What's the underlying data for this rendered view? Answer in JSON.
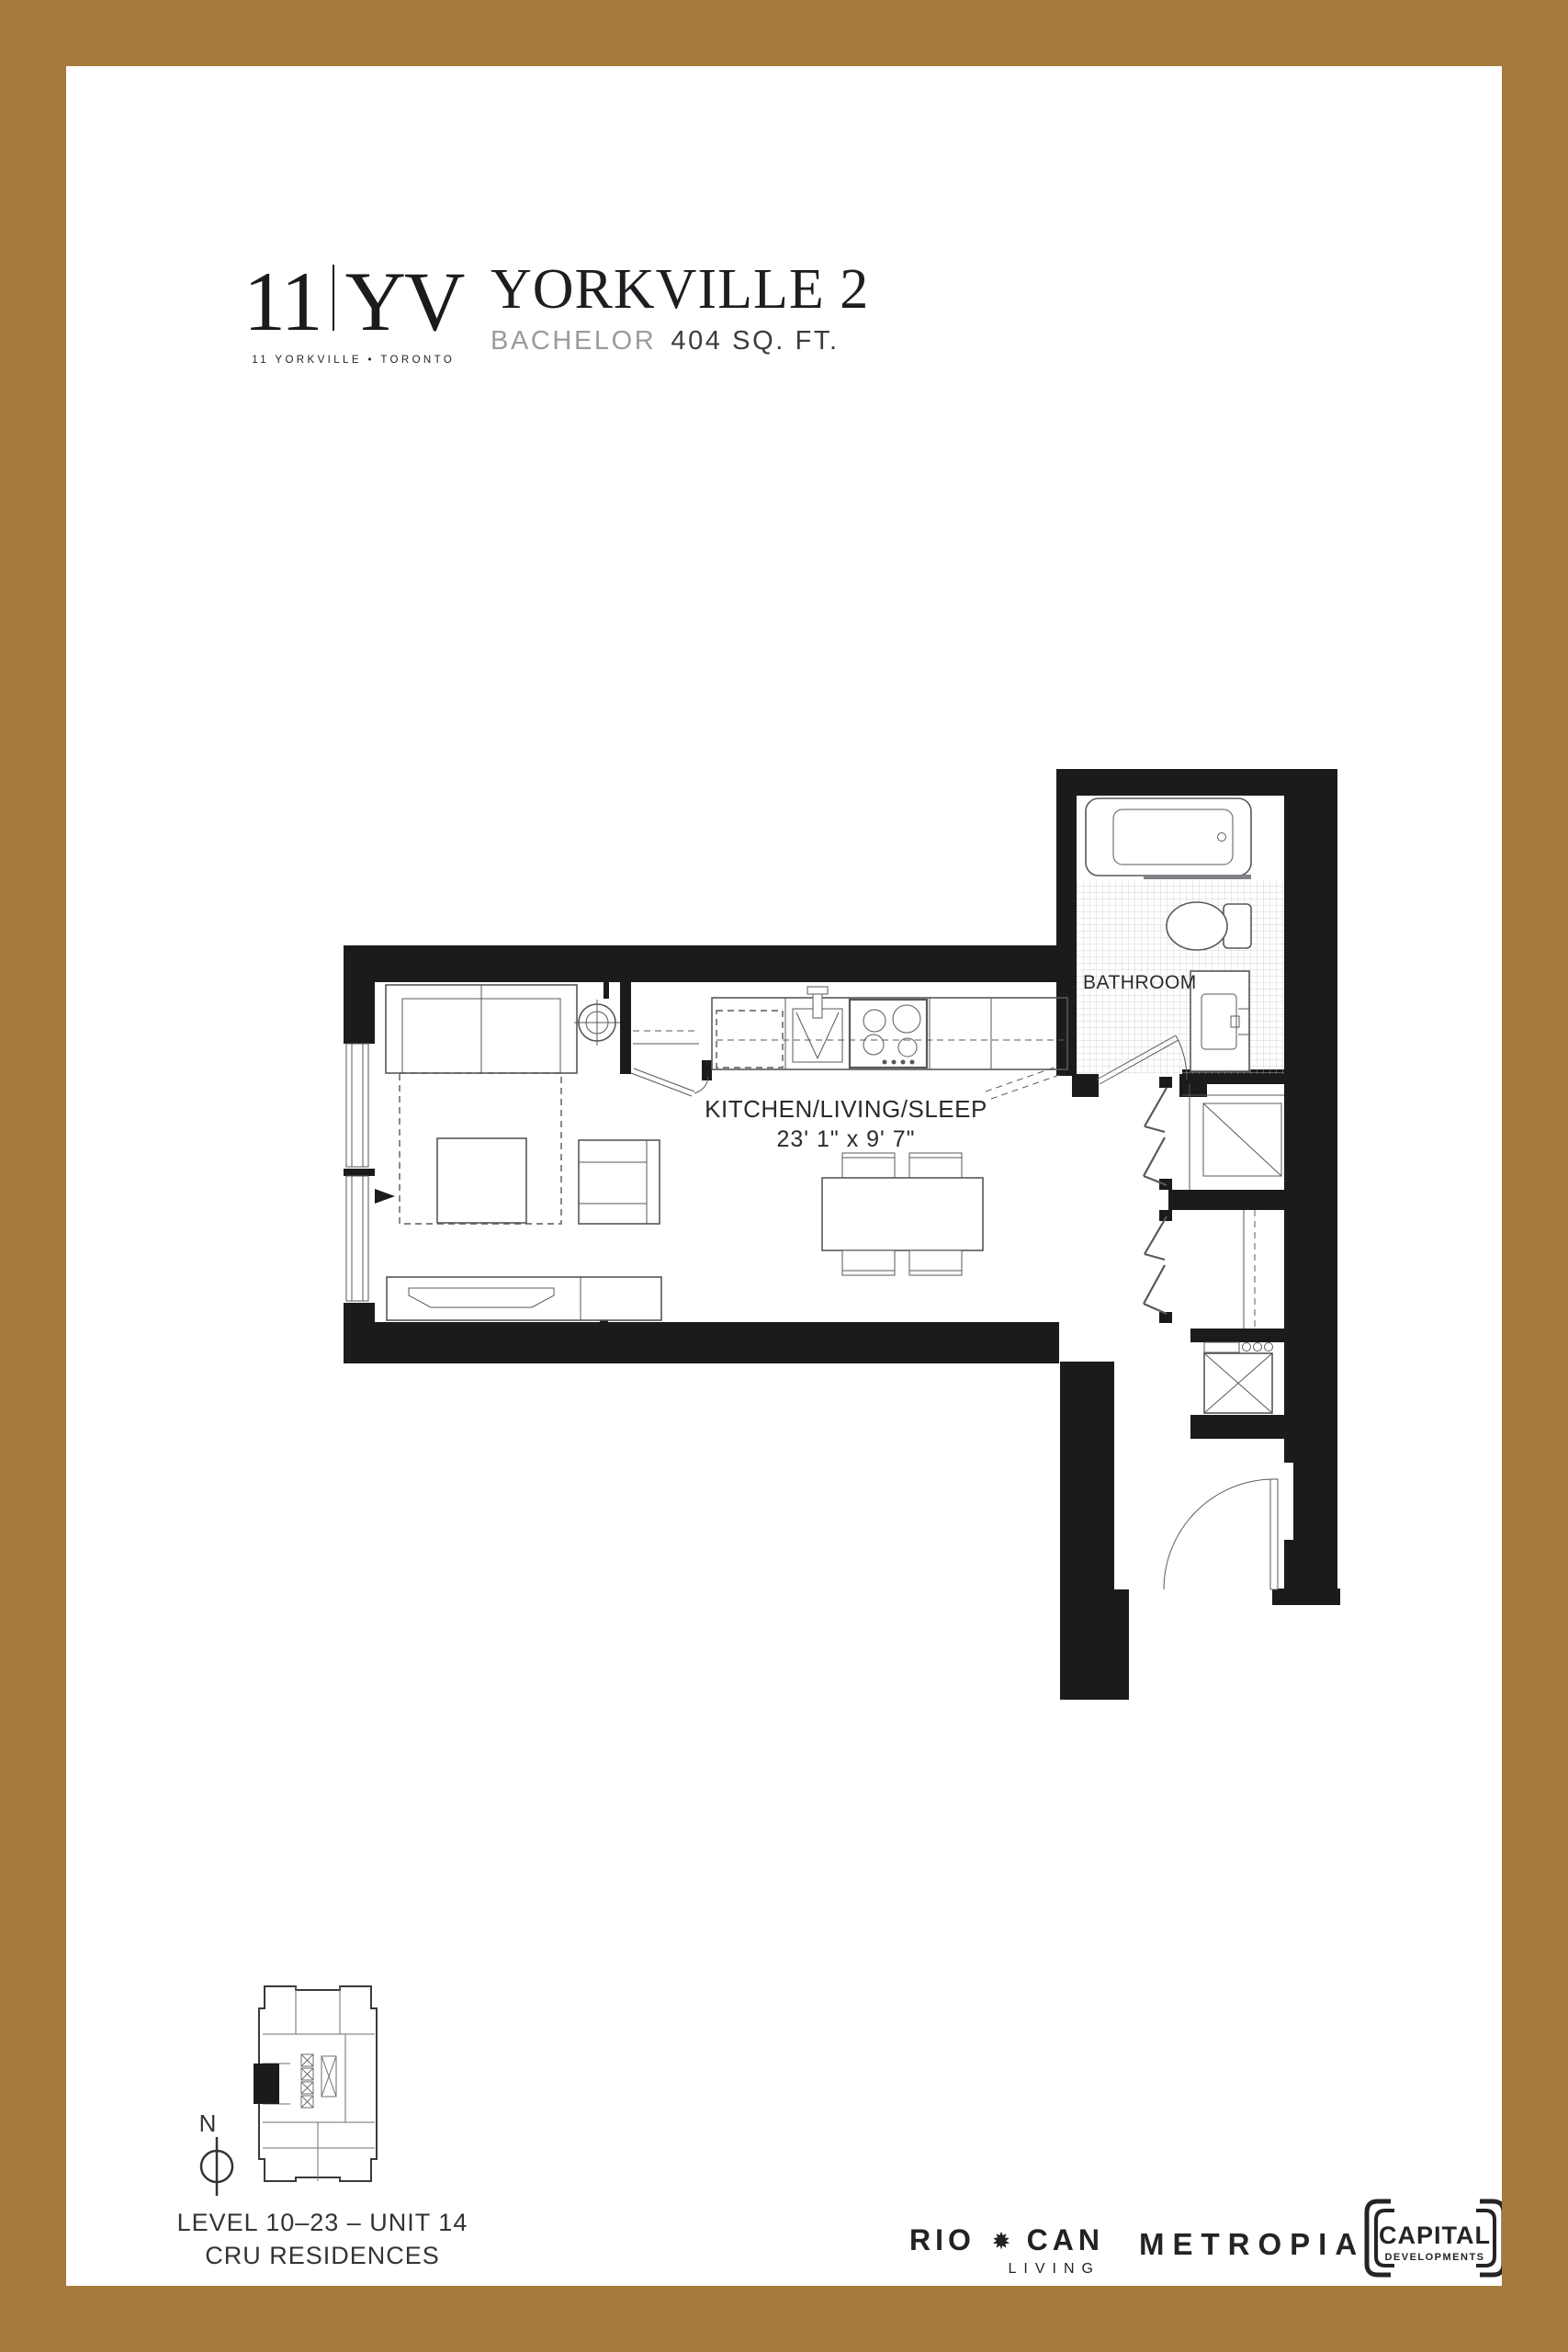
{
  "colors": {
    "border_gold": "#A6793A",
    "wall_black": "#1D1A1B",
    "muted_gray": "#9B9B9D"
  },
  "header": {
    "logo": {
      "number": "11",
      "letters": "YV",
      "tagline": "11 YORKVILLE • TORONTO"
    },
    "plan_name": "YORKVILLE 2",
    "unit_type": "BACHELOR",
    "area": "404 SQ. FT."
  },
  "floor_plan": {
    "room_label": "KITCHEN/LIVING/SLEEP",
    "room_dimensions": "23' 1\" x 9' 7\"",
    "bathroom_label": "BATHROOM"
  },
  "key_plan": {
    "north_label": "N",
    "level_line": "LEVEL 10–23 – UNIT 14",
    "residence_line": "CRU RESIDENCES"
  },
  "developers": {
    "riocan": {
      "word_left": "RIO",
      "word_right": "CAN",
      "subtitle": "LIVING"
    },
    "metropia": "METROPIA",
    "capital": {
      "line1": "CAPITAL",
      "line2": "DEVELOPMENTS"
    }
  },
  "disclaimer": {
    "line1": "Prices and specifications subject to change without notice. E. & O.E. The dimensions shown on this plan are approximate only. Actual useable floor space within the unit may vary from any stated floor areas or dimensions on this plan. For more information",
    "line2": "on the method used for calculating the floor area of any unit reference should be made to builder bulletin no.22 Published by Tarion. The size, location and/or configuration of the windows and spandrel glass shown may be changed, varied or mirrored."
  }
}
